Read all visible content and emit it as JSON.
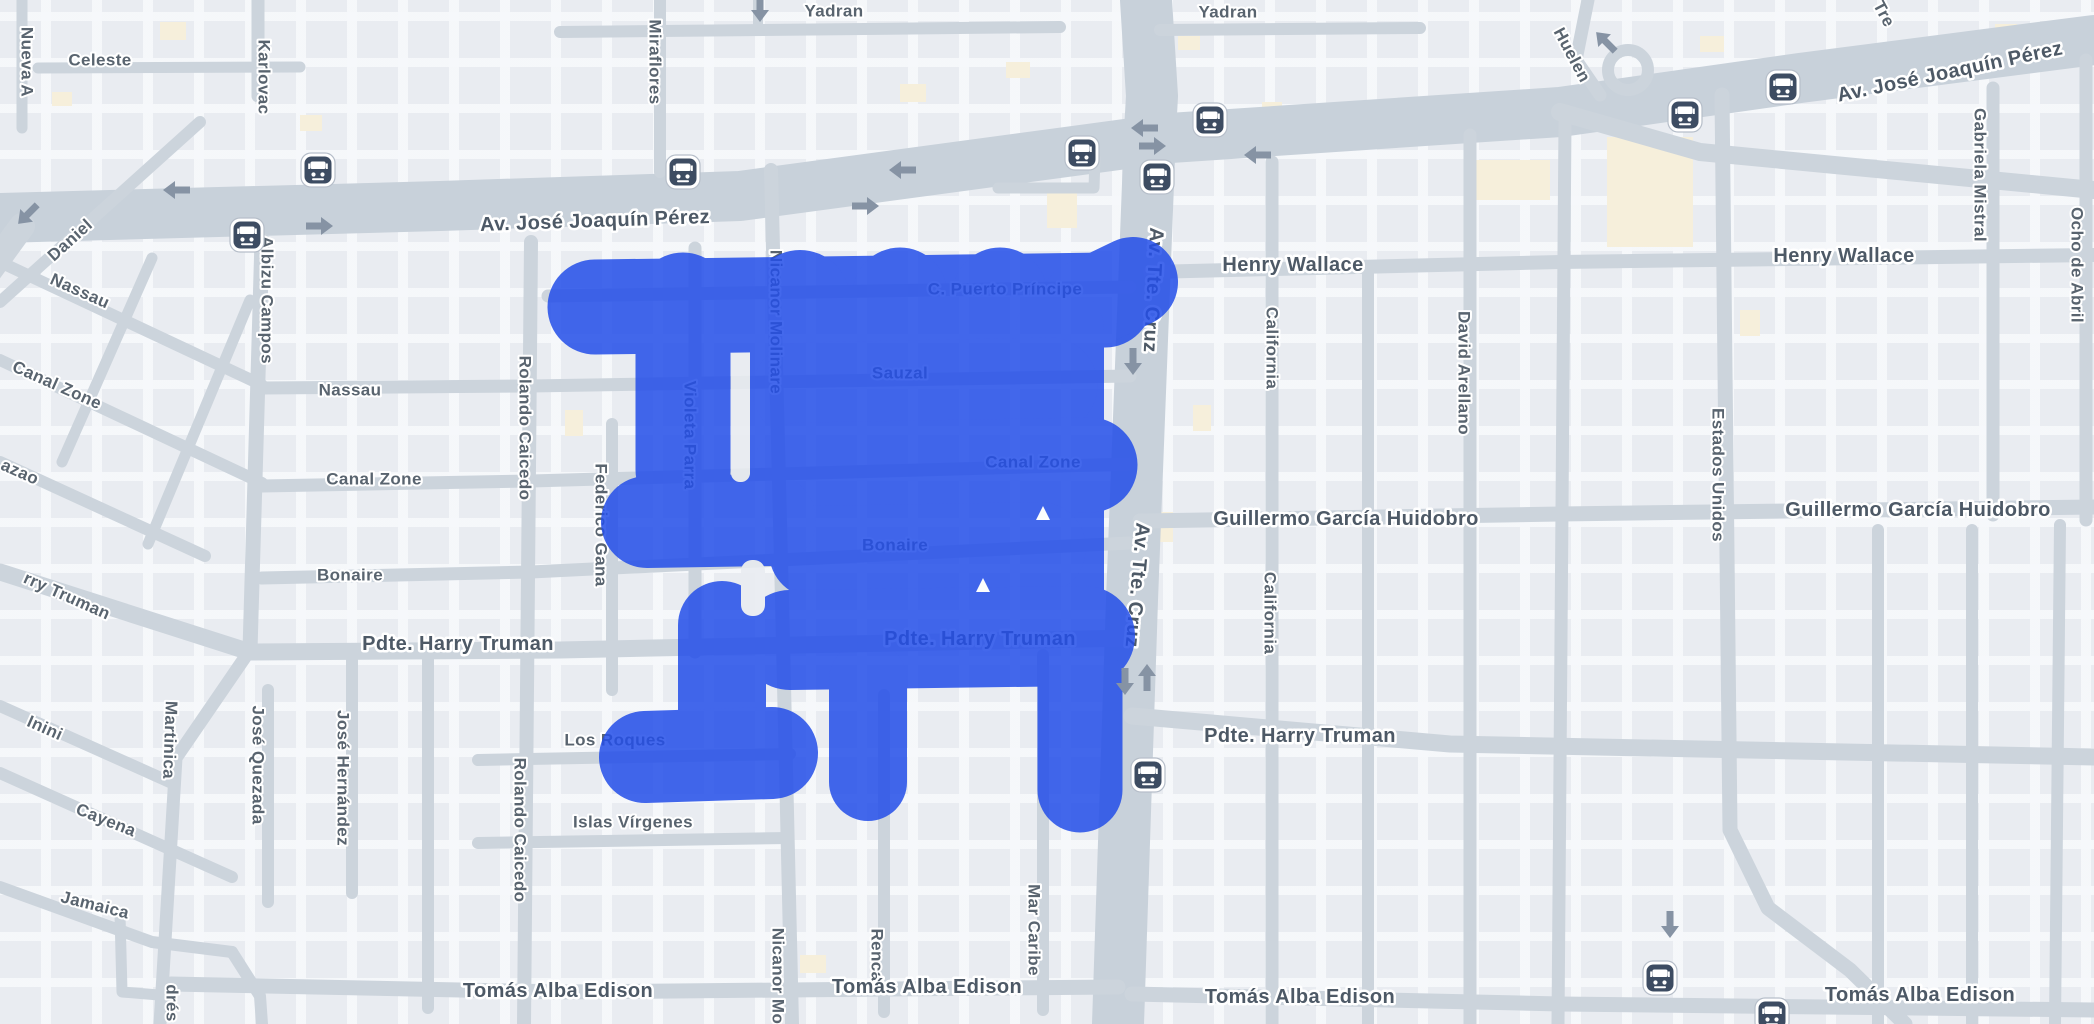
{
  "theme": {
    "background": "#e9ecf1",
    "road_color": "#ccd4dc",
    "avenue_color": "#c8d1da",
    "building_color": "#e4e8ee",
    "cream_building_color": "#f6efdb",
    "label_color": "#59646f",
    "major_label_color": "#4d5966",
    "halo_color": "#ffffff",
    "blob_color": "#234EE9",
    "blob_opacity": 0.85,
    "arrow_color": "#8693a4",
    "bus_icon_bg": "#3d4c62",
    "bus_icon_ring": "#ffffff",
    "bus_icon_outline": "#b6bec9"
  },
  "labels": [
    {
      "text": "Celeste",
      "x": 100,
      "y": 60,
      "rot": 0,
      "size": "s"
    },
    {
      "text": "Yadran",
      "x": 834,
      "y": 11,
      "rot": 0,
      "size": "s"
    },
    {
      "text": "Yadran",
      "x": 1228,
      "y": 12,
      "rot": 0,
      "size": "s"
    },
    {
      "text": "Nassau",
      "x": 350,
      "y": 390,
      "rot": 0,
      "size": "s"
    },
    {
      "text": "Canal Zone",
      "x": 374,
      "y": 479,
      "rot": 0,
      "size": "s"
    },
    {
      "text": "Bonaire",
      "x": 350,
      "y": 575,
      "rot": 0,
      "size": "s"
    },
    {
      "text": "Los Roques",
      "x": 615,
      "y": 740,
      "rot": 0,
      "size": "s"
    },
    {
      "text": "Islas Vírgenes",
      "x": 633,
      "y": 822,
      "rot": 0,
      "size": "s"
    },
    {
      "text": "C. Puerto Príncipe",
      "x": 1005,
      "y": 289,
      "rot": 0,
      "size": "s"
    },
    {
      "text": "Sauzal",
      "x": 900,
      "y": 373,
      "rot": 0,
      "size": "s"
    },
    {
      "text": "Canal Zone",
      "x": 1033,
      "y": 462,
      "rot": 0,
      "size": "s"
    },
    {
      "text": "Bonaire",
      "x": 895,
      "y": 545,
      "rot": 0,
      "size": "s"
    },
    {
      "text": "Daniel",
      "x": 70,
      "y": 240,
      "rot": -42,
      "size": "s"
    },
    {
      "text": "Nassau",
      "x": 80,
      "y": 291,
      "rot": 24,
      "size": "s"
    },
    {
      "text": "Canal Zone",
      "x": 57,
      "y": 385,
      "rot": 24,
      "size": "s"
    },
    {
      "text": "azao",
      "x": 20,
      "y": 472,
      "rot": 24,
      "size": "s"
    },
    {
      "text": "rry Truman",
      "x": 67,
      "y": 596,
      "rot": 24,
      "size": "s"
    },
    {
      "text": "Inini",
      "x": 45,
      "y": 728,
      "rot": 24,
      "size": "s"
    },
    {
      "text": "Cayena",
      "x": 106,
      "y": 820,
      "rot": 22,
      "size": "s"
    },
    {
      "text": "Jamaica",
      "x": 95,
      "y": 905,
      "rot": 14,
      "size": "s"
    },
    {
      "text": "Nueva A",
      "x": 27,
      "y": 62,
      "rot": 90,
      "size": "s"
    },
    {
      "text": "Karlovac",
      "x": 264,
      "y": 77,
      "rot": 90,
      "size": "s"
    },
    {
      "text": "Miraflores",
      "x": 655,
      "y": 62,
      "rot": 90,
      "size": "s"
    },
    {
      "text": "Albizu Campos",
      "x": 267,
      "y": 300,
      "rot": 90,
      "size": "s"
    },
    {
      "text": "Rolando Caicedo",
      "x": 525,
      "y": 428,
      "rot": 90,
      "size": "s"
    },
    {
      "text": "Rolando Caicedo",
      "x": 520,
      "y": 830,
      "rot": 90,
      "size": "s"
    },
    {
      "text": "Nicanor Molinare",
      "x": 776,
      "y": 322,
      "rot": 90,
      "size": "s"
    },
    {
      "text": "Nicanor Mo",
      "x": 778,
      "y": 976,
      "rot": 90,
      "size": "s"
    },
    {
      "text": "Violeta Parra",
      "x": 690,
      "y": 435,
      "rot": 90,
      "size": "s"
    },
    {
      "text": "Federico Gana",
      "x": 601,
      "y": 525,
      "rot": 90,
      "size": "s"
    },
    {
      "text": "José Quezada",
      "x": 258,
      "y": 765,
      "rot": 90,
      "size": "s"
    },
    {
      "text": "José Hernández",
      "x": 343,
      "y": 778,
      "rot": 90,
      "size": "s"
    },
    {
      "text": "Martinica",
      "x": 170,
      "y": 740,
      "rot": 92,
      "size": "s"
    },
    {
      "text": "drés",
      "x": 172,
      "y": 1003,
      "rot": 90,
      "size": "s"
    },
    {
      "text": "Renca",
      "x": 877,
      "y": 955,
      "rot": 90,
      "size": "s"
    },
    {
      "text": "Mar Caribe",
      "x": 1034,
      "y": 930,
      "rot": 90,
      "size": "s"
    },
    {
      "text": "California",
      "x": 1272,
      "y": 348,
      "rot": 90,
      "size": "s"
    },
    {
      "text": "California",
      "x": 1270,
      "y": 613,
      "rot": 90,
      "size": "s"
    },
    {
      "text": "David Arellano",
      "x": 1464,
      "y": 373,
      "rot": 90,
      "size": "s"
    },
    {
      "text": "Estados Unidos",
      "x": 1718,
      "y": 475,
      "rot": 90,
      "size": "s"
    },
    {
      "text": "Gabriela Mistral",
      "x": 1980,
      "y": 175,
      "rot": 90,
      "size": "s"
    },
    {
      "text": "Ocho de Abril",
      "x": 2077,
      "y": 265,
      "rot": 90,
      "size": "s"
    },
    {
      "text": "Huelen",
      "x": 1572,
      "y": 55,
      "rot": 62,
      "size": "s"
    },
    {
      "text": "Tre",
      "x": 1884,
      "y": 14,
      "rot": 62,
      "size": "s"
    },
    {
      "text": "Av. José Joaquín Pérez",
      "x": 595,
      "y": 221,
      "rot": -2,
      "size": "l"
    },
    {
      "text": "Av. José Joaquín Pérez",
      "x": 1950,
      "y": 72,
      "rot": -12,
      "size": "l"
    },
    {
      "text": "Henry Wallace",
      "x": 1293,
      "y": 265,
      "rot": 0,
      "size": "l"
    },
    {
      "text": "Henry Wallace",
      "x": 1844,
      "y": 256,
      "rot": 0,
      "size": "l"
    },
    {
      "text": "Guillermo García Huidobro",
      "x": 1346,
      "y": 519,
      "rot": 0,
      "size": "l"
    },
    {
      "text": "Guillermo García Huidobro",
      "x": 1918,
      "y": 510,
      "rot": 0,
      "size": "l"
    },
    {
      "text": "Pdte. Harry Truman",
      "x": 458,
      "y": 644,
      "rot": 0,
      "size": "l"
    },
    {
      "text": "Pdte. Harry Truman",
      "x": 980,
      "y": 639,
      "rot": 0,
      "size": "l"
    },
    {
      "text": "Pdte. Harry Truman",
      "x": 1300,
      "y": 736,
      "rot": 0,
      "size": "l"
    },
    {
      "text": "Tomás Alba Edison",
      "x": 558,
      "y": 991,
      "rot": 0,
      "size": "l"
    },
    {
      "text": "Tomás Alba Edison",
      "x": 927,
      "y": 987,
      "rot": 0,
      "size": "l"
    },
    {
      "text": "Tomás Alba Edison",
      "x": 1300,
      "y": 997,
      "rot": 0,
      "size": "l"
    },
    {
      "text": "Tomás Alba Edison",
      "x": 1920,
      "y": 995,
      "rot": 0,
      "size": "l"
    },
    {
      "text": "Av. Tte. Cruz",
      "x": 1153,
      "y": 290,
      "rot": 93,
      "size": "l"
    },
    {
      "text": "Av. Tte. Cruz",
      "x": 1137,
      "y": 585,
      "rot": 95,
      "size": "l"
    }
  ],
  "roads": [
    {
      "pts": "0,218 440,206 740,196 1170,138 1560,112 1800,78 2094,40",
      "w": 50,
      "major": true
    },
    {
      "pts": "1146,0 1152,96 1150,132 1132,600 1118,1024",
      "w": 52,
      "major": true
    },
    {
      "pts": "1560,112 1700,152 2094,190",
      "w": 18
    },
    {
      "pts": "1588,0 1576,60 1600,95",
      "w": 13
    },
    {
      "pts": "38,68 300,67",
      "w": 11
    },
    {
      "pts": "22,0 22,128",
      "w": 11
    },
    {
      "pts": "258,0 258,96",
      "w": 13
    },
    {
      "pts": "262,240 250,650",
      "w": 15
    },
    {
      "pts": "250,650 176,758 160,1024",
      "w": 13
    },
    {
      "pts": "0,302 200,122",
      "w": 12
    },
    {
      "pts": "0,262 262,385",
      "w": 12
    },
    {
      "pts": "0,360 262,483",
      "w": 12
    },
    {
      "pts": "0,462 205,556",
      "w": 12
    },
    {
      "pts": "0,572 250,652 560,650 1132,638",
      "w": 17
    },
    {
      "pts": "0,706 172,783",
      "w": 12
    },
    {
      "pts": "0,773 232,877",
      "w": 12
    },
    {
      "pts": "0,887 152,942 232,952",
      "w": 12
    },
    {
      "pts": "232,952 260,996 262,1024",
      "w": 12
    },
    {
      "pts": "120,915 122,992 171,996",
      "w": 11
    },
    {
      "pts": "152,258 62,462",
      "w": 11
    },
    {
      "pts": "250,300 148,544",
      "w": 11
    },
    {
      "pts": "262,388 531,386 1130,376",
      "w": 13
    },
    {
      "pts": "262,486 531,481 1130,464",
      "w": 13
    },
    {
      "pts": "262,578 531,572 1130,543",
      "w": 13
    },
    {
      "pts": "548,296 1130,287",
      "w": 13
    },
    {
      "pts": "531,242 524,1024",
      "w": 14
    },
    {
      "pts": "660,0 660,172",
      "w": 12
    },
    {
      "pts": "771,170 782,600 792,1024",
      "w": 14
    },
    {
      "pts": "695,248 695,652",
      "w": 13
    },
    {
      "pts": "612,424 612,690",
      "w": 12
    },
    {
      "pts": "268,690 268,902",
      "w": 12
    },
    {
      "pts": "352,655 352,893",
      "w": 12
    },
    {
      "pts": "428,652 428,1008",
      "w": 12
    },
    {
      "pts": "884,695 884,1012",
      "w": 12
    },
    {
      "pts": "1043,655 1043,1010",
      "w": 12
    },
    {
      "pts": "478,760 790,754",
      "w": 12
    },
    {
      "pts": "478,843 788,838",
      "w": 12
    },
    {
      "pts": "171,984 560,992 1118,987",
      "w": 15
    },
    {
      "pts": "1132,994 1560,1004 2094,1010",
      "w": 15
    },
    {
      "pts": "1132,716 1450,744 2094,757",
      "w": 17
    },
    {
      "pts": "1150,272 1560,262 2094,255",
      "w": 14
    },
    {
      "pts": "1140,521 1560,514 2094,507",
      "w": 15
    },
    {
      "pts": "1272,162 1272,1024",
      "w": 13
    },
    {
      "pts": "1368,270 1368,1024",
      "w": 12
    },
    {
      "pts": "1470,135 1470,1024",
      "w": 13
    },
    {
      "pts": "1565,122 1558,1024",
      "w": 13
    },
    {
      "pts": "1722,95 1730,830 1768,908 1850,970 1905,1024",
      "w": 15
    },
    {
      "pts": "1993,88 1993,515",
      "w": 13
    },
    {
      "pts": "2086,60 2086,520",
      "w": 13
    },
    {
      "pts": "1878,530 1878,1024",
      "w": 12
    },
    {
      "pts": "1972,530 1972,1024",
      "w": 12
    },
    {
      "pts": "2060,525 2055,1024",
      "w": 12
    },
    {
      "pts": "560,32 1060,27",
      "w": 12
    },
    {
      "pts": "1160,30 1420,28",
      "w": 12
    },
    {
      "pts": "758,0 758,30",
      "w": 10
    },
    {
      "pts": "998,188 1094,188 1095,158",
      "w": 11
    },
    {
      "pts": "22,226 -10,270",
      "w": 26
    }
  ],
  "road_loop": {
    "x": 1628,
    "y": 70,
    "r": 20,
    "w": 12
  },
  "cream_buildings": [
    {
      "x": 160,
      "y": 22,
      "w": 26,
      "h": 18
    },
    {
      "x": 300,
      "y": 115,
      "w": 22,
      "h": 16
    },
    {
      "x": 900,
      "y": 84,
      "w": 26,
      "h": 18
    },
    {
      "x": 1006,
      "y": 62,
      "w": 24,
      "h": 16
    },
    {
      "x": 1178,
      "y": 36,
      "w": 22,
      "h": 14
    },
    {
      "x": 1262,
      "y": 102,
      "w": 20,
      "h": 14
    },
    {
      "x": 1047,
      "y": 183,
      "w": 30,
      "h": 45
    },
    {
      "x": 1607,
      "y": 137,
      "w": 86,
      "h": 110
    },
    {
      "x": 1473,
      "y": 160,
      "w": 77,
      "h": 40
    },
    {
      "x": 1193,
      "y": 405,
      "w": 18,
      "h": 26
    },
    {
      "x": 1155,
      "y": 512,
      "w": 18,
      "h": 30
    },
    {
      "x": 565,
      "y": 410,
      "w": 18,
      "h": 26
    },
    {
      "x": 800,
      "y": 955,
      "w": 26,
      "h": 18
    },
    {
      "x": 1115,
      "y": 947,
      "w": 22,
      "h": 16
    },
    {
      "x": 1700,
      "y": 36,
      "w": 24,
      "h": 16
    },
    {
      "x": 1995,
      "y": 24,
      "w": 22,
      "h": 14
    },
    {
      "x": 52,
      "y": 92,
      "w": 20,
      "h": 14
    },
    {
      "x": 1740,
      "y": 310,
      "w": 20,
      "h": 26
    }
  ],
  "blob": {
    "strokes": [
      {
        "x1": 595,
        "y1": 307,
        "x2": 1105,
        "y2": 300,
        "w": 95
      },
      {
        "x1": 1085,
        "y1": 305,
        "x2": 1133,
        "y2": 282,
        "w": 90
      },
      {
        "x1": 683,
        "y1": 300,
        "x2": 683,
        "y2": 470,
        "w": 95
      },
      {
        "x1": 800,
        "y1": 300,
        "x2": 800,
        "y2": 490,
        "w": 100
      },
      {
        "x1": 900,
        "y1": 295,
        "x2": 900,
        "y2": 545,
        "w": 95
      },
      {
        "x1": 1000,
        "y1": 295,
        "x2": 1000,
        "y2": 545,
        "w": 95
      },
      {
        "x1": 1060,
        "y1": 330,
        "x2": 1060,
        "y2": 600,
        "w": 88
      },
      {
        "x1": 800,
        "y1": 390,
        "x2": 1050,
        "y2": 385,
        "w": 95
      },
      {
        "x1": 800,
        "y1": 470,
        "x2": 1090,
        "y2": 465,
        "w": 95
      },
      {
        "x1": 815,
        "y1": 552,
        "x2": 1040,
        "y2": 548,
        "w": 92
      },
      {
        "x1": 790,
        "y1": 640,
        "x2": 1085,
        "y2": 636,
        "w": 100
      },
      {
        "x1": 722,
        "y1": 625,
        "x2": 722,
        "y2": 735,
        "w": 88
      },
      {
        "x1": 645,
        "y1": 757,
        "x2": 772,
        "y2": 753,
        "w": 92
      },
      {
        "x1": 647,
        "y1": 522,
        "x2": 770,
        "y2": 520,
        "w": 92
      },
      {
        "x1": 868,
        "y1": 680,
        "x2": 868,
        "y2": 782,
        "w": 78
      },
      {
        "x1": 1080,
        "y1": 680,
        "x2": 1080,
        "y2": 790,
        "w": 85
      }
    ],
    "gaps": [
      {
        "x": 731,
        "y": 356,
        "w": 19,
        "h": 126,
        "r": 9
      },
      {
        "x": 741,
        "y": 560,
        "w": 24,
        "h": 56,
        "r": 11
      }
    ],
    "notches": [
      {
        "x": 1043,
        "y": 514
      },
      {
        "x": 983,
        "y": 586
      }
    ]
  },
  "bus_stops": [
    {
      "x": 318,
      "y": 170
    },
    {
      "x": 247,
      "y": 235
    },
    {
      "x": 683,
      "y": 172
    },
    {
      "x": 1082,
      "y": 153
    },
    {
      "x": 1157,
      "y": 177
    },
    {
      "x": 1210,
      "y": 120
    },
    {
      "x": 1685,
      "y": 115
    },
    {
      "x": 1783,
      "y": 87
    },
    {
      "x": 1148,
      "y": 775
    },
    {
      "x": 1660,
      "y": 978
    },
    {
      "x": 1772,
      "y": 1015
    }
  ],
  "arrows": [
    {
      "x": 177,
      "y": 190,
      "rot": 180
    },
    {
      "x": 319,
      "y": 226,
      "rot": 0
    },
    {
      "x": 903,
      "y": 170,
      "rot": 180
    },
    {
      "x": 865,
      "y": 206,
      "rot": 0
    },
    {
      "x": 1145,
      "y": 128,
      "rot": 180
    },
    {
      "x": 1152,
      "y": 146,
      "rot": 0
    },
    {
      "x": 1258,
      "y": 155,
      "rot": 180
    },
    {
      "x": 28,
      "y": 214,
      "rot": 135
    },
    {
      "x": 1133,
      "y": 361,
      "rot": 90
    },
    {
      "x": 1125,
      "y": 681,
      "rot": 90
    },
    {
      "x": 1147,
      "y": 678,
      "rot": -90
    },
    {
      "x": 1670,
      "y": 924,
      "rot": 90
    },
    {
      "x": 760,
      "y": 8,
      "rot": 90
    },
    {
      "x": 1606,
      "y": 42,
      "rot": -135
    }
  ]
}
